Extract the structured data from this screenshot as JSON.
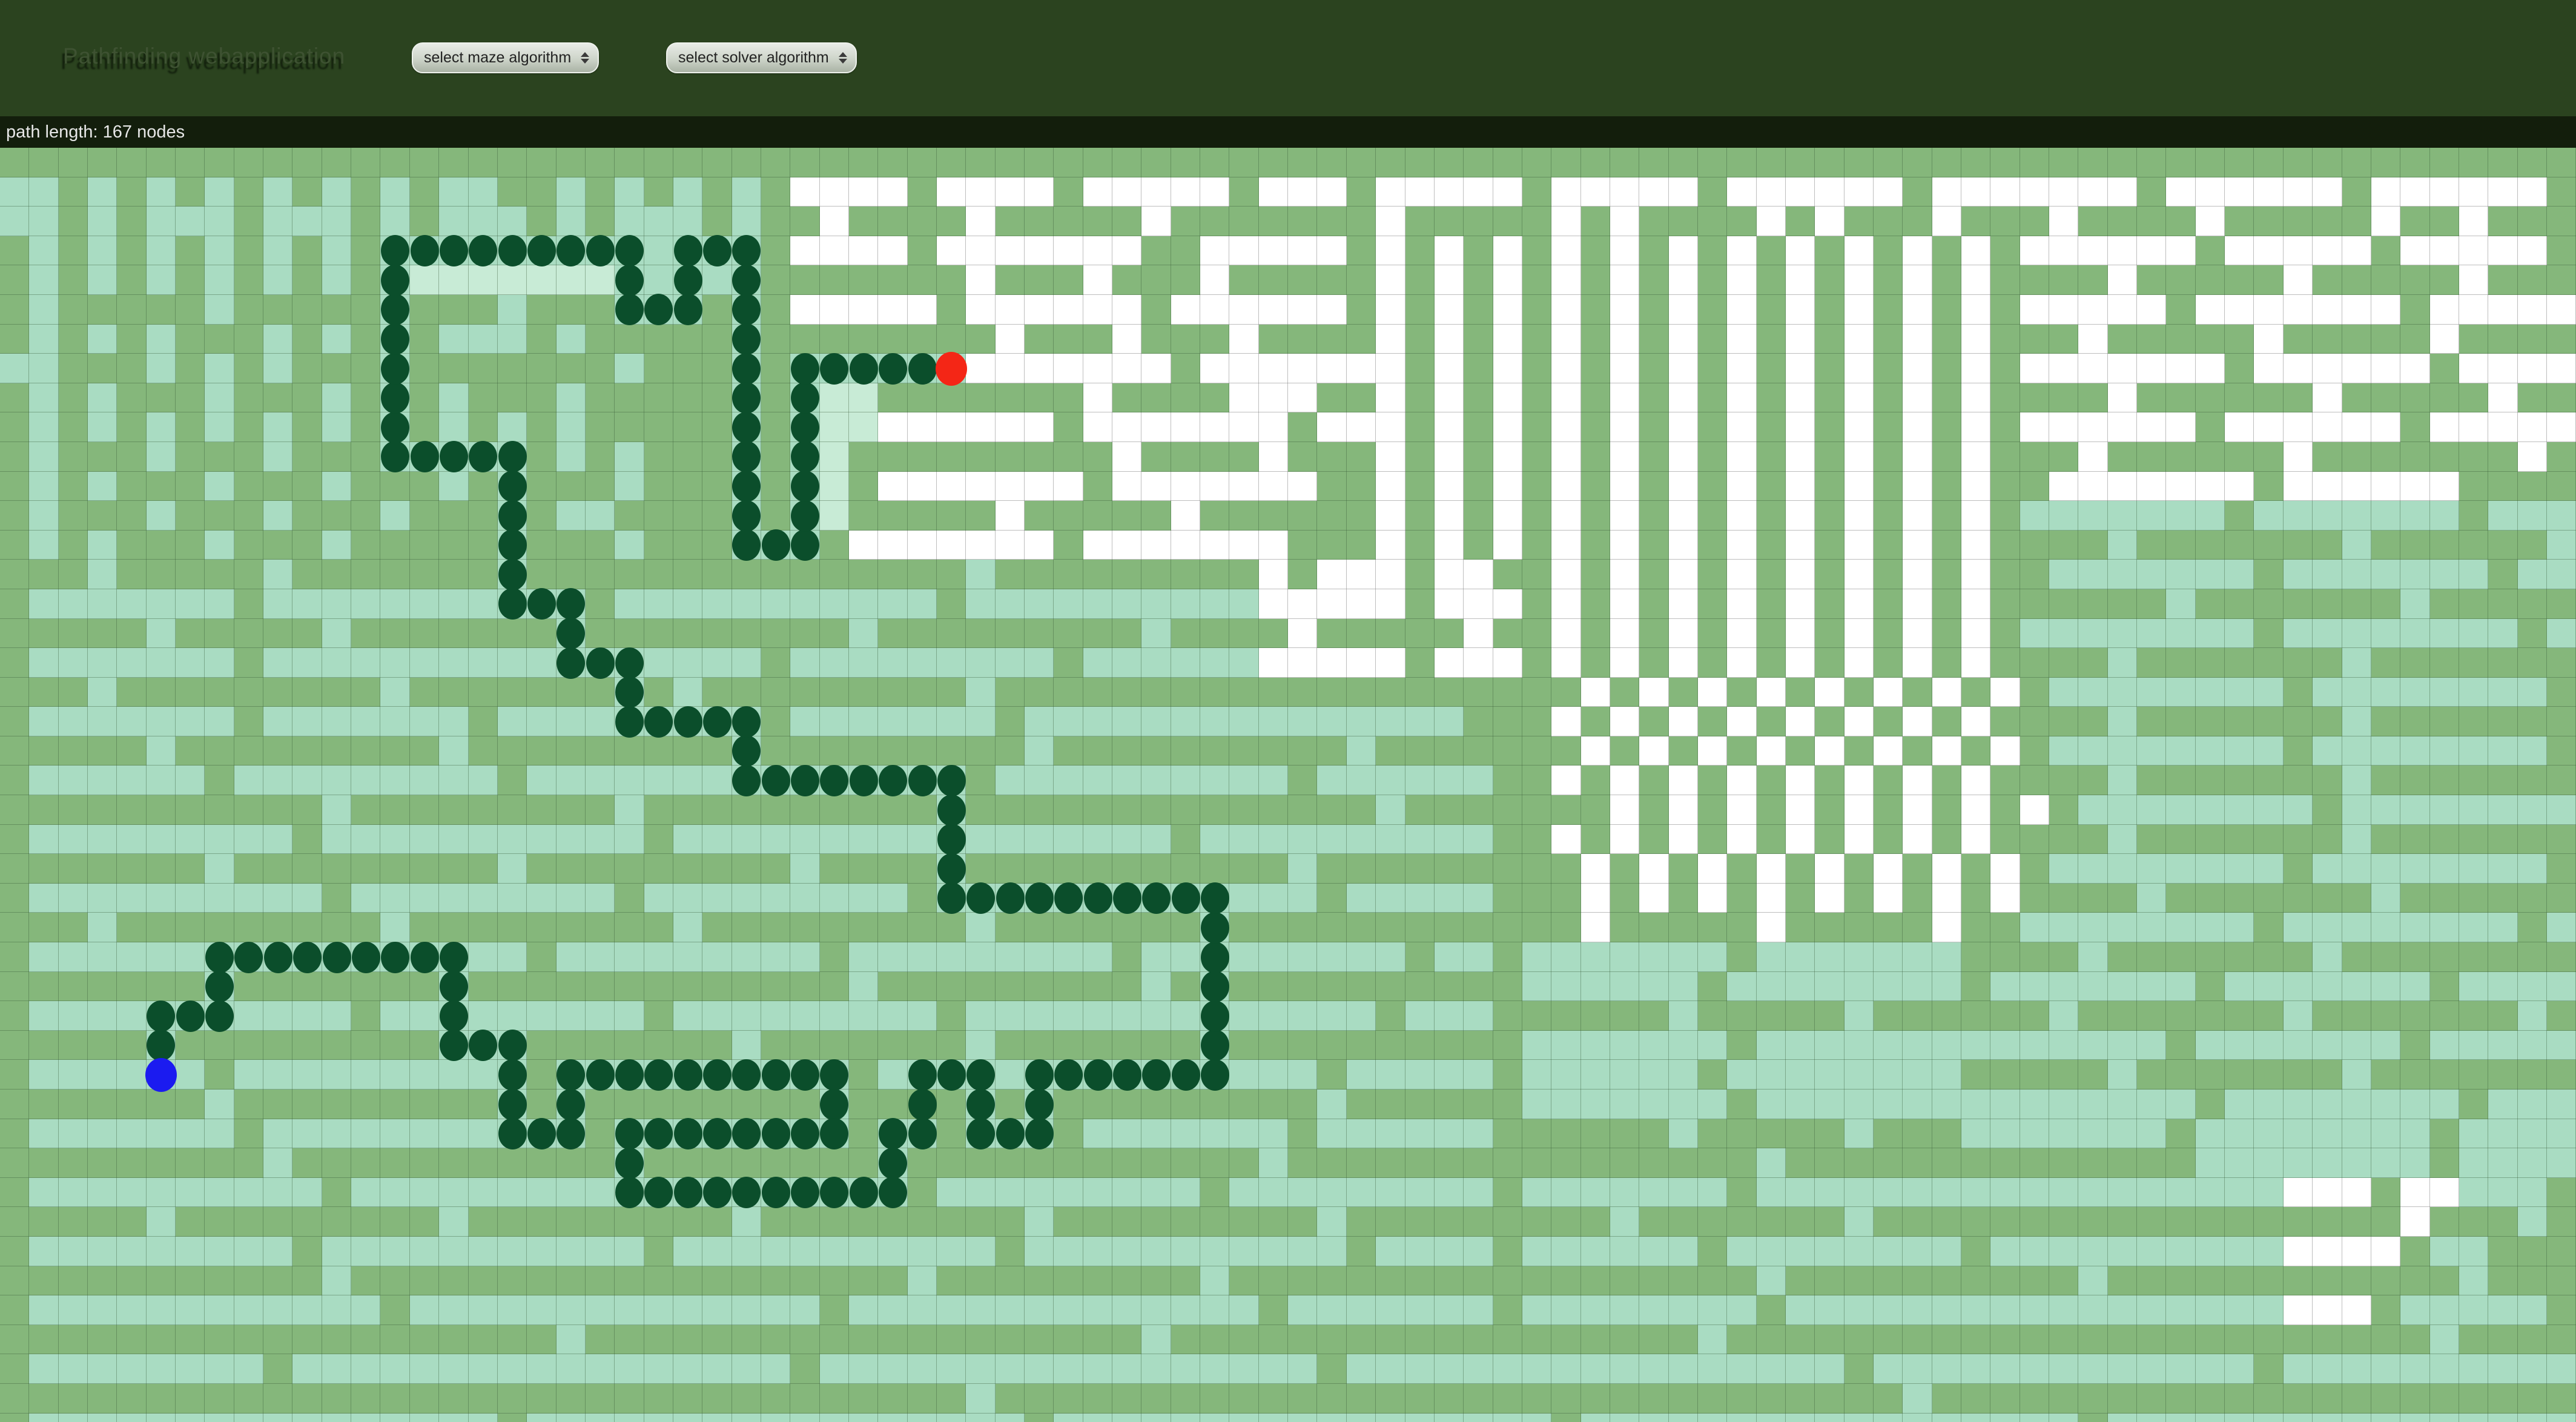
{
  "header": {
    "title": "Pathfinding webapplication",
    "maze_select_label": "select maze algorithm",
    "solver_select_label": "select solver algorithm"
  },
  "status": {
    "text": "path length: 167 nodes"
  },
  "maze": {
    "cols": 88,
    "rows": 44,
    "cell_w": 48.35,
    "cell_h": 48.6,
    "colors": {
      "wall_green": "#85b77b",
      "visited_mint": "#a9dcc2",
      "visited_light_mint": "#c8ebd6",
      "unvisited_white": "#ffffff",
      "path_dot_dark_green": "#0b4e2b",
      "start_blue": "#1b1bf0",
      "end_red": "#f42616",
      "gridline": "rgba(50,85,50,0.38)",
      "header_bg": "#2b431f",
      "statusbar_bg": "#131e0c"
    },
    "cells": [
      "ggggggggggggggggggggggggggggggggggggggggggggggggggggggggggggggggggggggggggggggggggggggg",
      "mmgmgmgmgmgmgmgmmggmgmgmgmgwwwwgwwwwgwwwwwgwwwgwwwwwgwwwwwgwwwwwwgwwwwwwwgwwwwwwgwwwwwwg",
      "mmgmgmmmgmmmgmgmmmgmgmmmgmggwggggwgggggwgggggggwgggggwgwggggwgwgggwgggwggggwgggggwggwggg",
      "gmgmgmgmgmgmgmmmmmmmmmmmmmgwwwwgwwwwwwwggwwwwwgwgwgwgwgwgwgwgwgwgwgwgwwwwwwgwwwwwgwwwwwgwg",
      "gmgmgmgmgmgmgmlllllllmmmmmgggggggwgggwgggwgggggwgwgwgwgwgwgwgwgwgwgwggggwgggggwgggggwggggg",
      "gmgggggmgggggmgggmgggmmmgmgwwwwwgwwwwwwgwwwwwwgwgwgwgwgwgwgwgwgwgwgwgwwwwwgwwwwwwwgwwwwwwg",
      "gmgmgmgggmgmgmgmmmgmgggggmggggggggwgggwgggwggggwgwgwgwgwgwgwgwgwgwgwgggwgggggwgggggwggggwg",
      "mmgggmgmgmgggmgggggggmgggmgmmmmmmwwwwwwwgwwwwwwwgwgwgwgwgwgwgwgwgwgwgwwwwwwwgwwwwwwgwwwwwg",
      "gmgmgggmgggmgmgmgggmgggggmgmllgggggggwggggwwwggwgwgwgwgwgwgwgwgwgwgwggggwggggggwgggggwgggg",
      "gmgmgmgmgmgmgmgmgmgmgggggmgmllwwwwwwgwwwwwwwgwwwgwgwgwgwgwgwgwgwgwgwgwwwwwwgwwwwwwgwwwwwgg",
      "gmgggmgggmgggmmmmmgmgmgggmgmlgggggggggwggggwgggwgwgwgwgwgwgwgwgwgwgwgggwggggggwgggggggwggg",
      "gmgmgggmgggmgggmgmgggmgggmgmlgwwwwwwwgwwwwwwwggwgwgwgwgwgwgwgwgwgwgwggwwwwwwwgwwwwwwgggggg",
      "gmgggmgggmgggmgggmgmmggggmgmlgggggwgggggwggggggwgwgwgwgwgwgwgwgwgwgwgmmmmmmmgmmmmmmmgmmmmm",
      "gmgmgggmgggmgggggmgggmgggmmmgwwwwwwwgwwwwwwwgggwgwgwgwgwgwgwgwgwgwgwggggmgggggggmggggggmgg",
      "gggmgggggmgggggggmgggggggggggggggmgggggggggwgwwwgwwggwgwgwgwgwgwgwgwggmmmmmmmgmmmmmmmgmmmg",
      "gmmmmmmmgmmmmmmmmmmmgmmmmmmmmmmmgmmmmmmmmmmwwwwwgwwwgwgwgwgwgwgwgwgwggggggmgggggggmggggggg",
      "gggggmgggggmgggggggmgggggggggmgggggggggmggggwgggggwggwgwgwgwgwgwgwgwgmmmmmmmmgmmmmmmmmgmmm",
      "gmmmmmmmgmmmmmmmmmmmmmmmmmgmmmmmmmmmgmmmmmmwwwwwgwwwgwgwgwgwgwgwgwgwggggmgggggggmgggggggmg",
      "gggmgggggggggmgggggggmgmgggggggggmggggggggggggggggggggwgwgwgwgwgwgwgwgmmmmmmmmgmmmmmmmmgmmm",
      "gmmmmmmmgmmmmmmmgmmmmmmmmmgmmmmmmmgmmmmmmmmmmmmmmmgggwgwgwgwgwgwgwgwggggmgggggggmgggggggmg",
      "gggggmgggggggggmgggggggggmgggggggggmggggggggggmgggggggwgwgwgwgwgwgwgwgmmmmmmmmgmmmmmmmmgmmm",
      "gmmmmmmgmmmmmmmmmgmmmmmmmmmmmmmmmgmmmmmmmmmmgmmmmmmggwgwgwgwgwgwgwgwggggmgggggggmgggggggmg",
      "gggggggggggmgggggggggmggggggggggmggggggggggggggmgggggggwgwgwgwgwgwgwgwgmmmmmmmmgmmmmmmmmgmmm",
      "gmmmmmmmmmgmmmmmmmmmmmgmmmmmmmmmmmmmmmmmgmmmmmmmmmmggwgwgwgwgwgwgwgwggggmgggggggmgggggggmg",
      "gggggggmgggggggggmgggggggggmggggmgggggggggggmgggggggggwgwgwgwgwgwgwgwgmmmmmmmmgmmmmmmmmgmmm",
      "gmmmmmmmmmmgmmmmmmmmmgmmmmmmmmmgmmmmmmmmmmmmmgmmmmmgggwgwgwgwgwgwgwgwggggmgggggggmgggggggmg",
      "gggmgggggggggmgggggggggmgggggggggmgggggggmggggggggggggwgggggwgggggwggmmmmmmmmgmmmmmmmmgmmm",
      "gmmmmmmmmmmmmmmmmmgmmmmmmmmmgmmmmmmmmmgmmmmmmmmmgmmgmmmmmmmgmmmmmmmggggmgggggggmgggggggg",
      "gggggggmgggggggmgggggggggggggmgggggggggmgmggggggggggmmmmmmgmmmmmmmmgmmmmmmmgmmmmmmmgmmmm",
      "gmmmmmmmmmmmgmmmmmmmmmgmmmmmmmmmgmmmmmmmmmmmmmmgmmmggggggmgggggmggggggmgggggggmgggggggmg",
      "gggggmgggggggggmmmgggggggmgggggggmgggggggmggggggggggmmmmmmmgmmmmmmmmmmmmmmgmmmmmmmgmmmmm",
      "gmmmmmmgmmmmmmmmmmgmmmmmmmmmmgmmmmmmmmmmmmmmmgmmmmmgmmmmmmgmmmmmmmmgggggmgggggggmggggggg",
      "gggggggmgggggggggmgmggggggggmggggmgmgggggggggmggggggmmmmmmmgmmmmmmmmmmmmmmmgmmmmmmmmgmmm",
      "gmmmmmmmgmmmmmmmmmmmgmmmmmmmmgmmgmmmgmmmmmmmgmmmmmmggggggmgggggmgggmmmmmmmgmmmmmmmmgmmmm",
      "gggggggggmgggggggggggmggggggggmggggggggggggmggggggggggggggggmggggggggggggggmmmmmmmmgmmmm",
      "gmmmmmmmmmmgmmmmmmmmmmmmmmmmmmmgmmmmmmmmmgmmmmmmmmmgmmmmmmmgmmmmmmmmmmmmmmmmmmwwwgwwmmmg",
      "gggggmgggggggggmgggggggggmgggggggggmgggggggggmgggggggggmgggggggmggggggggggggggggggwgggmggg",
      "gmmmmmmmmmgmmmmmmmmmmmgmmmmmmmmmmmgmmmmmmmmmmmgmmmmgmmmmmmgmmmmmmmmgmmmmmmmmmmwwwwgmmggg",
      "gggggggggggmgggggggggggggggggggmgggggggggmggggggggggggggggggmggggggggggmggggggggggggmggg",
      "gmmmmmmmmmmmmgmmmmmmmmmmmmmmgmmmmmmmmmmmmmmgmmmmmmmgmmmmmmmmgmmmmmmmmmmmmmmmmmwwwgmmmmmg",
      "gggggggggggggggggggmgggggggggggggggggggmggggggggggggggggggmggggggggggggggggggggggggmggg",
      "gmmmmmmmmgmmmmmmmmmmmmmmmmmgmmmmmmmmmmmmmmmmmgmmmmmmmmmmmmmmmmmgmmmmmmmmmmmmmgmmmmmmmmmm",
      "gggggggggggggggggggggggggggggggggmgggggggggggggggggggggggggggggggmgggggggggggggggggggggg",
      "gmmmmmmmmmmmmmmmmgmmmmmmmmmmmmmmmmmgmmmmmmmmmmmmmmmmmgmmmmmmmmmmmmmmmmmgmmmmmmmmmmmmmmmm"
    ],
    "path": [
      [
        5,
        31
      ],
      [
        5,
        30
      ],
      [
        5,
        29
      ],
      [
        6,
        29
      ],
      [
        7,
        29
      ],
      [
        7,
        28
      ],
      [
        7,
        27
      ],
      [
        8,
        27
      ],
      [
        9,
        27
      ],
      [
        10,
        27
      ],
      [
        11,
        27
      ],
      [
        12,
        27
      ],
      [
        13,
        27
      ],
      [
        14,
        27
      ],
      [
        15,
        27
      ],
      [
        15,
        28
      ],
      [
        15,
        29
      ],
      [
        15,
        30
      ],
      [
        16,
        30
      ],
      [
        17,
        30
      ],
      [
        17,
        31
      ],
      [
        17,
        32
      ],
      [
        17,
        33
      ],
      [
        18,
        33
      ],
      [
        19,
        33
      ],
      [
        19,
        32
      ],
      [
        19,
        31
      ],
      [
        20,
        31
      ],
      [
        21,
        31
      ],
      [
        22,
        31
      ],
      [
        23,
        31
      ],
      [
        24,
        31
      ],
      [
        25,
        31
      ],
      [
        26,
        31
      ],
      [
        27,
        31
      ],
      [
        28,
        31
      ],
      [
        28,
        32
      ],
      [
        28,
        33
      ],
      [
        27,
        33
      ],
      [
        26,
        33
      ],
      [
        25,
        33
      ],
      [
        24,
        33
      ],
      [
        23,
        33
      ],
      [
        22,
        33
      ],
      [
        21,
        33
      ],
      [
        21,
        34
      ],
      [
        21,
        35
      ],
      [
        22,
        35
      ],
      [
        23,
        35
      ],
      [
        24,
        35
      ],
      [
        25,
        35
      ],
      [
        26,
        35
      ],
      [
        27,
        35
      ],
      [
        28,
        35
      ],
      [
        29,
        35
      ],
      [
        30,
        35
      ],
      [
        30,
        34
      ],
      [
        30,
        33
      ],
      [
        31,
        33
      ],
      [
        31,
        32
      ],
      [
        31,
        31
      ],
      [
        32,
        31
      ],
      [
        33,
        31
      ],
      [
        33,
        32
      ],
      [
        33,
        33
      ],
      [
        34,
        33
      ],
      [
        35,
        33
      ],
      [
        35,
        32
      ],
      [
        35,
        31
      ],
      [
        36,
        31
      ],
      [
        37,
        31
      ],
      [
        38,
        31
      ],
      [
        39,
        31
      ],
      [
        40,
        31
      ],
      [
        41,
        31
      ],
      [
        41,
        30
      ],
      [
        41,
        29
      ],
      [
        41,
        28
      ],
      [
        41,
        27
      ],
      [
        41,
        26
      ],
      [
        41,
        25
      ],
      [
        40,
        25
      ],
      [
        39,
        25
      ],
      [
        38,
        25
      ],
      [
        37,
        25
      ],
      [
        36,
        25
      ],
      [
        35,
        25
      ],
      [
        34,
        25
      ],
      [
        33,
        25
      ],
      [
        32,
        25
      ],
      [
        32,
        24
      ],
      [
        32,
        23
      ],
      [
        32,
        22
      ],
      [
        32,
        21
      ],
      [
        31,
        21
      ],
      [
        30,
        21
      ],
      [
        29,
        21
      ],
      [
        28,
        21
      ],
      [
        27,
        21
      ],
      [
        26,
        21
      ],
      [
        25,
        21
      ],
      [
        25,
        20
      ],
      [
        25,
        19
      ],
      [
        24,
        19
      ],
      [
        23,
        19
      ],
      [
        22,
        19
      ],
      [
        21,
        19
      ],
      [
        21,
        18
      ],
      [
        21,
        17
      ],
      [
        20,
        17
      ],
      [
        19,
        17
      ],
      [
        19,
        16
      ],
      [
        19,
        15
      ],
      [
        18,
        15
      ],
      [
        17,
        15
      ],
      [
        17,
        14
      ],
      [
        17,
        13
      ],
      [
        17,
        12
      ],
      [
        17,
        11
      ],
      [
        17,
        10
      ],
      [
        16,
        10
      ],
      [
        15,
        10
      ],
      [
        14,
        10
      ],
      [
        13,
        10
      ],
      [
        13,
        9
      ],
      [
        13,
        8
      ],
      [
        13,
        7
      ],
      [
        13,
        6
      ],
      [
        13,
        5
      ],
      [
        13,
        4
      ],
      [
        13,
        3
      ],
      [
        14,
        3
      ],
      [
        15,
        3
      ],
      [
        16,
        3
      ],
      [
        17,
        3
      ],
      [
        18,
        3
      ],
      [
        19,
        3
      ],
      [
        20,
        3
      ],
      [
        21,
        3
      ],
      [
        21,
        4
      ],
      [
        21,
        5
      ],
      [
        22,
        5
      ],
      [
        23,
        5
      ],
      [
        23,
        4
      ],
      [
        23,
        3
      ],
      [
        24,
        3
      ],
      [
        25,
        3
      ],
      [
        25,
        4
      ],
      [
        25,
        5
      ],
      [
        25,
        6
      ],
      [
        25,
        7
      ],
      [
        25,
        8
      ],
      [
        25,
        9
      ],
      [
        25,
        10
      ],
      [
        25,
        11
      ],
      [
        25,
        12
      ],
      [
        25,
        13
      ],
      [
        26,
        13
      ],
      [
        27,
        13
      ],
      [
        27,
        12
      ],
      [
        27,
        11
      ],
      [
        27,
        10
      ],
      [
        27,
        9
      ],
      [
        27,
        8
      ],
      [
        27,
        7
      ],
      [
        28,
        7
      ],
      [
        29,
        7
      ],
      [
        30,
        7
      ],
      [
        31,
        7
      ],
      [
        32,
        7
      ]
    ],
    "start": [
      5,
      31
    ],
    "end": [
      32,
      7
    ]
  }
}
